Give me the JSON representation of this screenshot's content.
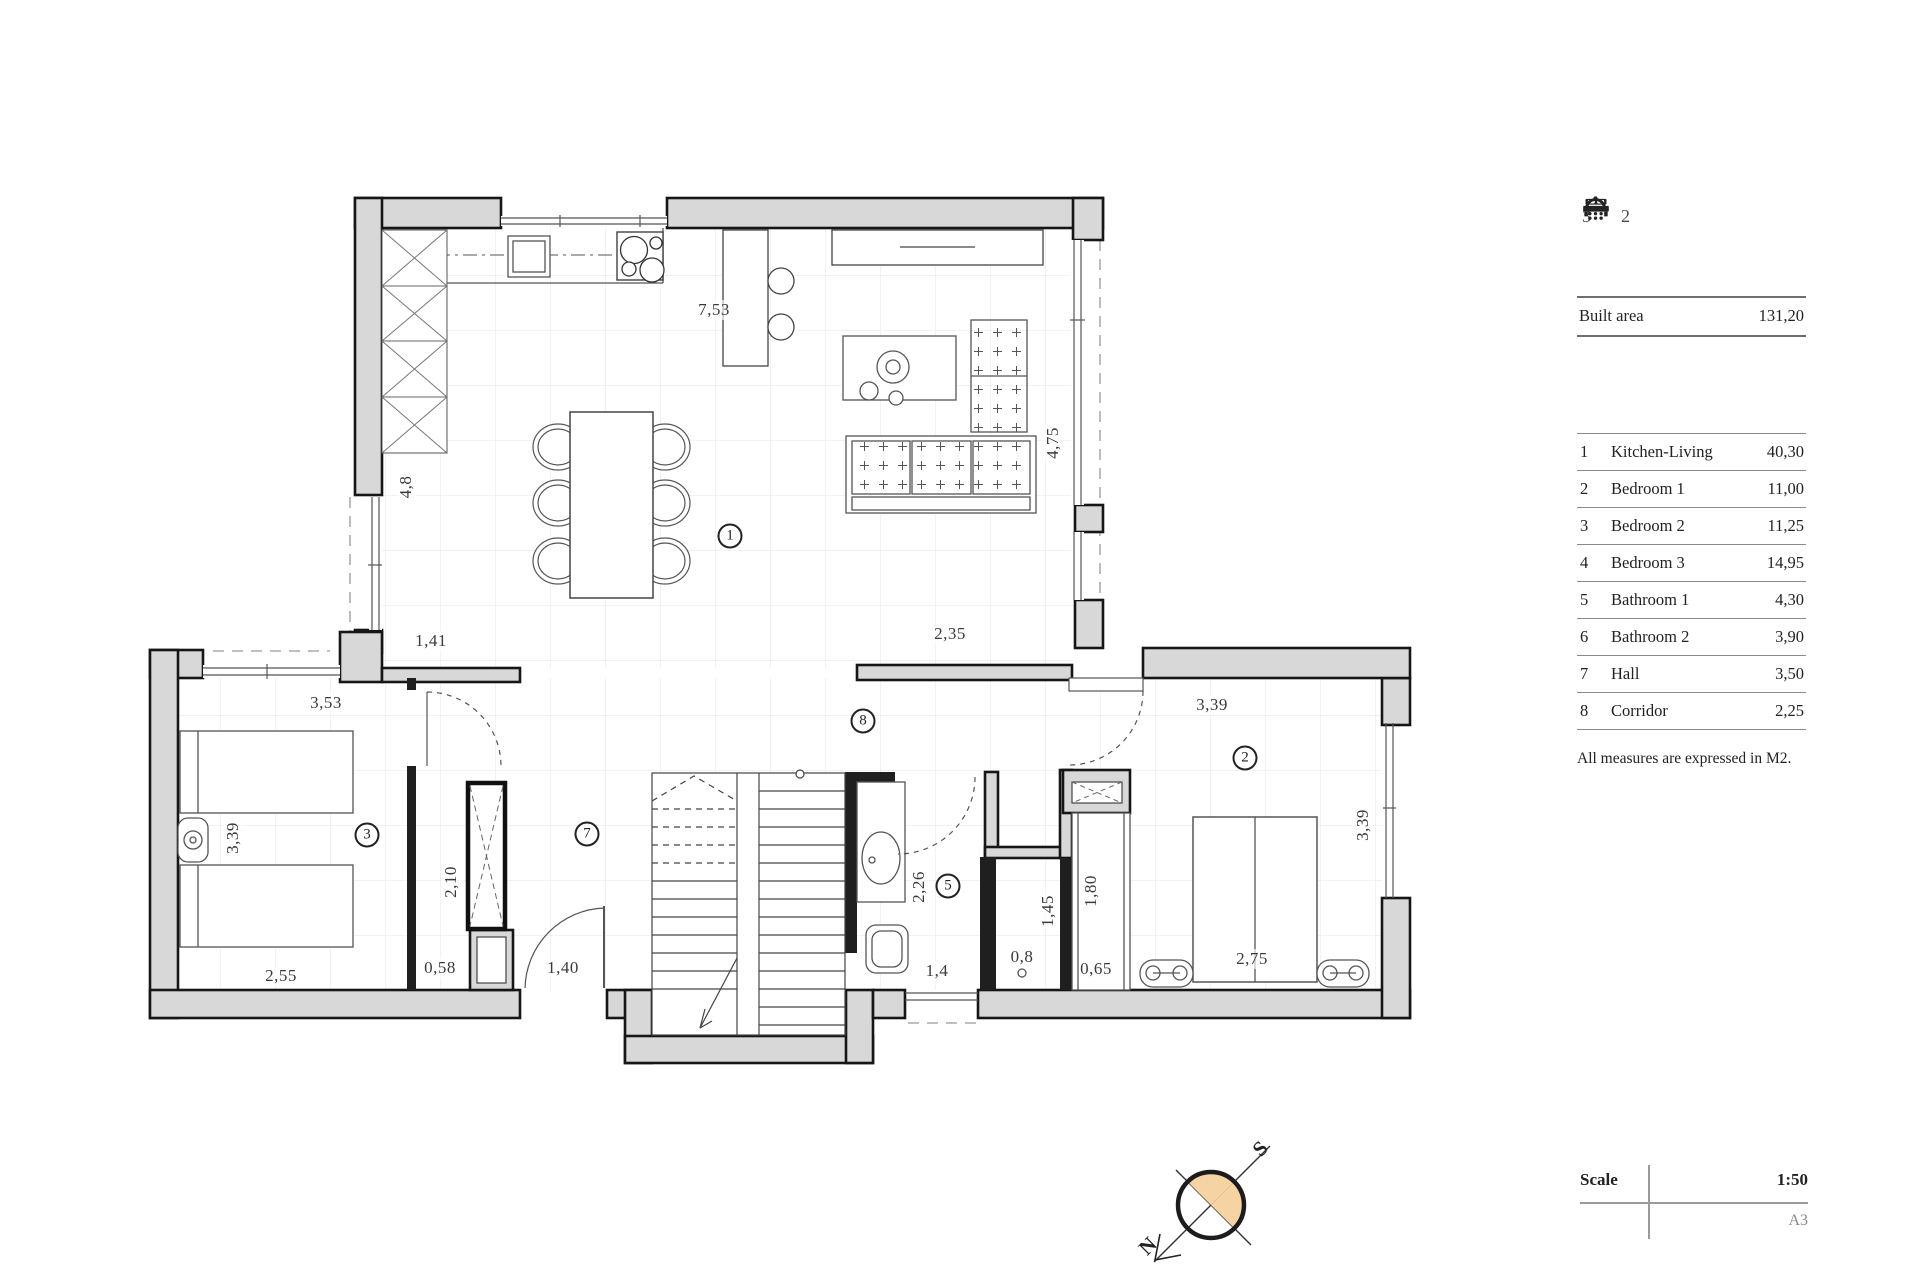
{
  "summary_icons": {
    "bedrooms": "3",
    "bathrooms": "2"
  },
  "built_area": {
    "label": "Built area",
    "value": "131,20"
  },
  "legend": {
    "rows": [
      {
        "num": "1",
        "name": "Kitchen-Living",
        "area": "40,30"
      },
      {
        "num": "2",
        "name": "Bedroom 1",
        "area": "11,00"
      },
      {
        "num": "3",
        "name": "Bedroom 2",
        "area": "11,25"
      },
      {
        "num": "4",
        "name": "Bedroom 3",
        "area": "14,95"
      },
      {
        "num": "5",
        "name": "Bathroom 1",
        "area": "4,30"
      },
      {
        "num": "6",
        "name": "Bathroom 2",
        "area": "3,90"
      },
      {
        "num": "7",
        "name": "Hall",
        "area": "3,50"
      },
      {
        "num": "8",
        "name": "Corridor",
        "area": "2,25"
      }
    ]
  },
  "note": "All measures are expressed in M2.",
  "scale_block": {
    "label": "Scale",
    "value": "1:50",
    "sheet": "A3"
  },
  "compass": {
    "north_label": "N",
    "south_label": "S",
    "fill_color": "#f5d3a2"
  },
  "plan": {
    "wall_fill": "#d8d8d8",
    "room_markers": [
      {
        "num": "1",
        "x": 730,
        "y": 536
      },
      {
        "num": "2",
        "x": 1245,
        "y": 758
      },
      {
        "num": "3",
        "x": 367,
        "y": 835
      },
      {
        "num": "5",
        "x": 948,
        "y": 886
      },
      {
        "num": "7",
        "x": 587,
        "y": 834
      },
      {
        "num": "8",
        "x": 863,
        "y": 721
      }
    ],
    "dimensions": [
      {
        "text": "7,53",
        "x": 714,
        "y": 310,
        "rot": 0
      },
      {
        "text": "4,75",
        "x": 1053,
        "y": 443,
        "rot": -90
      },
      {
        "text": "4,8",
        "x": 406,
        "y": 487,
        "rot": -90
      },
      {
        "text": "1,41",
        "x": 431,
        "y": 641,
        "rot": 0
      },
      {
        "text": "2,35",
        "x": 950,
        "y": 634,
        "rot": 0
      },
      {
        "text": "3,53",
        "x": 326,
        "y": 703,
        "rot": 0
      },
      {
        "text": "3,39",
        "x": 233,
        "y": 838,
        "rot": -90
      },
      {
        "text": "3,39",
        "x": 1212,
        "y": 705,
        "rot": 0
      },
      {
        "text": "3,39",
        "x": 1363,
        "y": 825,
        "rot": -90
      },
      {
        "text": "2,55",
        "x": 281,
        "y": 976,
        "rot": 0
      },
      {
        "text": "2,10",
        "x": 451,
        "y": 882,
        "rot": -90
      },
      {
        "text": "0,58",
        "x": 440,
        "y": 968,
        "rot": 0
      },
      {
        "text": "1,40",
        "x": 563,
        "y": 968,
        "rot": 0
      },
      {
        "text": "1,4",
        "x": 937,
        "y": 971,
        "rot": 0
      },
      {
        "text": "0,8",
        "x": 1022,
        "y": 957,
        "rot": 0
      },
      {
        "text": "2,26",
        "x": 919,
        "y": 887,
        "rot": -90
      },
      {
        "text": "1,45",
        "x": 1048,
        "y": 911,
        "rot": -90
      },
      {
        "text": "1,80",
        "x": 1091,
        "y": 891,
        "rot": -90
      },
      {
        "text": "0,65",
        "x": 1096,
        "y": 969,
        "rot": 0
      },
      {
        "text": "2,75",
        "x": 1252,
        "y": 959,
        "rot": 0
      }
    ]
  }
}
